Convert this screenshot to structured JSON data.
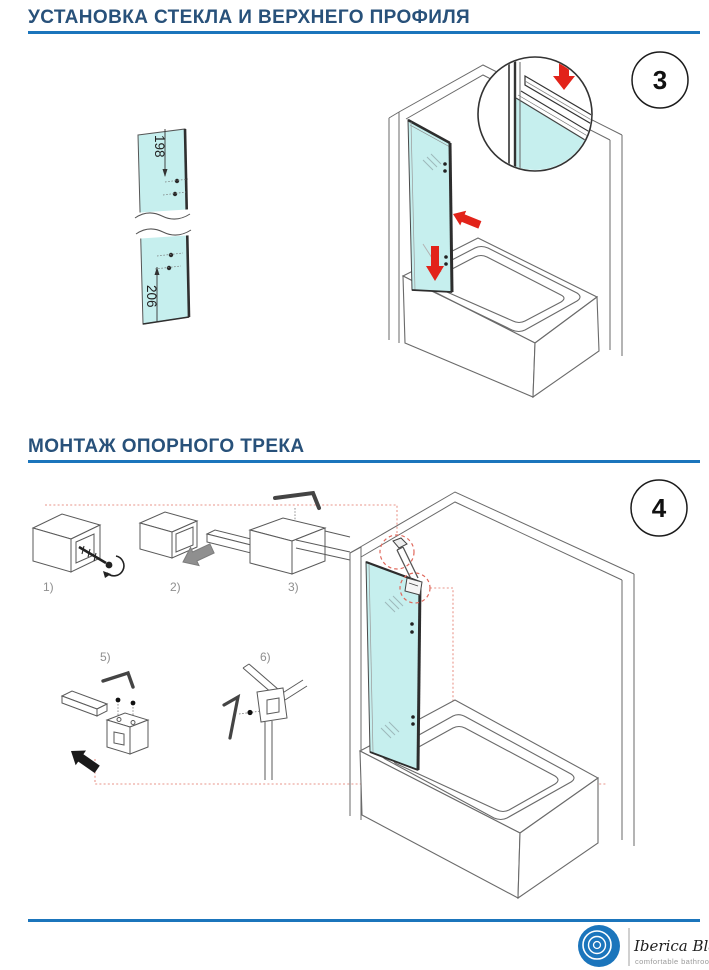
{
  "section1": {
    "title": "УСТАНОВКА СТЕКЛА И ВЕРХНЕГО ПРОФИЛЯ",
    "step_badge": "3",
    "glass_dimensions": {
      "top": "198",
      "bottom": "206"
    }
  },
  "section2": {
    "title": "МОНТАЖ ОПОРНОГО ТРЕКА",
    "step_badge": "4",
    "step_labels": [
      "1)",
      "2)",
      "3)",
      "5)",
      "6)"
    ]
  },
  "footer": {
    "brand": "Iberica Blanca",
    "tagline": "comfortable bathroom",
    "logo_icon": "concentric-rings-logo"
  },
  "colors": {
    "header_text": "#28517a",
    "accent_blue": "#1b75bc",
    "glass_cyan": "#c6efee",
    "arrow_red": "#e2231a",
    "guide_red_dotted": "#e9968b",
    "line_art": "#4f4f4f",
    "step_label_gray": "#8f8f8f"
  }
}
